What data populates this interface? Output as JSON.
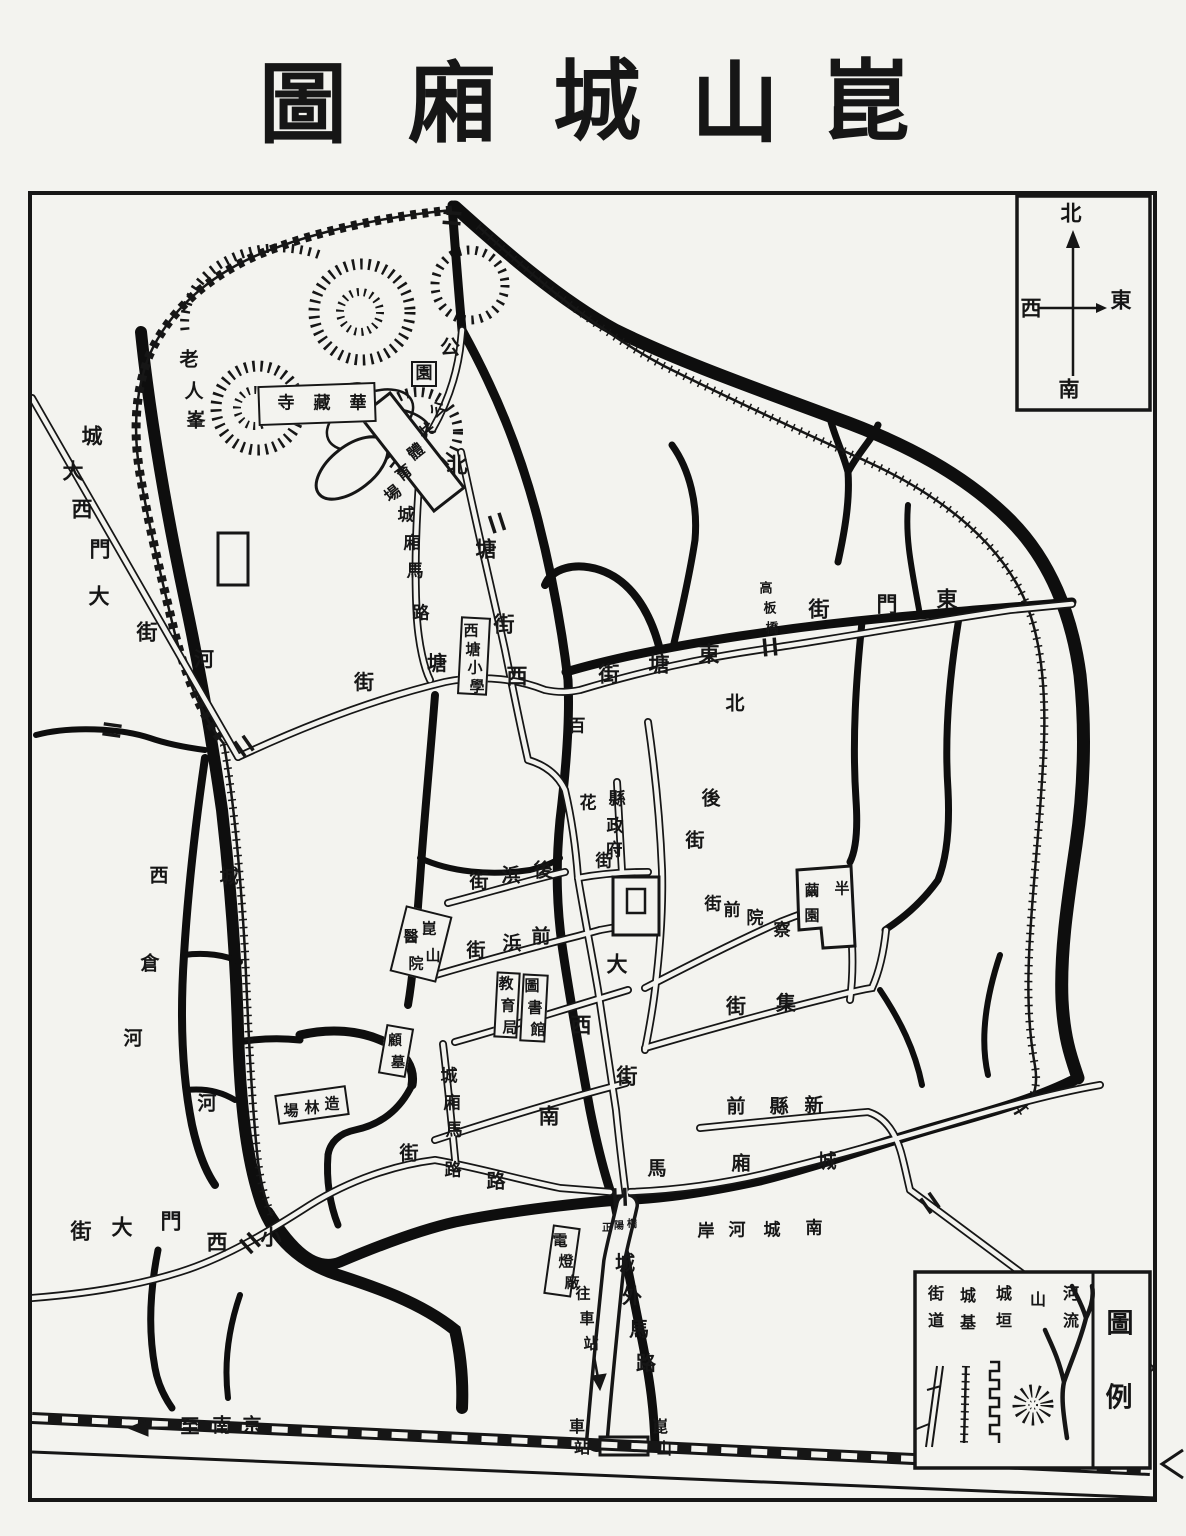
{
  "meta": {
    "title": "崑山城廂圖"
  },
  "colors": {
    "ink": "#161616",
    "paper": "#f3f3ef"
  },
  "compass": {
    "north": "北",
    "south": "南",
    "east": "東",
    "west": "西"
  },
  "legend": {
    "title": "圖例",
    "items": [
      {
        "label": "河流",
        "symbol": "river-branch"
      },
      {
        "label": "山",
        "symbol": "mountain-hachure"
      },
      {
        "label": "城垣",
        "symbol": "crenellated-wall"
      },
      {
        "label": "城基",
        "symbol": "wall-foundation"
      },
      {
        "label": "街道",
        "symbol": "double-line-street"
      }
    ]
  },
  "labels": [
    {
      "name": "map-title",
      "text": "崑山城廂圖",
      "size": 88,
      "chars": [
        [
          "圖",
          303,
          104
        ],
        [
          "廂",
          452,
          103
        ],
        [
          "城",
          597,
          101
        ],
        [
          "山",
          735,
          103
        ],
        [
          "崑",
          866,
          101
        ]
      ]
    },
    {
      "name": "compass-north",
      "text": "北",
      "size": 21,
      "chars": [
        [
          "北",
          1071,
          213
        ]
      ]
    },
    {
      "name": "compass-south",
      "text": "南",
      "size": 21,
      "chars": [
        [
          "南",
          1069,
          389
        ]
      ]
    },
    {
      "name": "compass-west",
      "text": "西",
      "size": 21,
      "chars": [
        [
          "西",
          1031,
          308
        ]
      ]
    },
    {
      "name": "compass-east",
      "text": "東",
      "size": 21,
      "chars": [
        [
          "東",
          1121,
          300
        ]
      ]
    },
    {
      "name": "legend-title",
      "text": "圖例",
      "size": 27,
      "chars": [
        [
          "圖",
          1120,
          1324
        ],
        [
          "例",
          1119,
          1398
        ]
      ]
    },
    {
      "name": "legend-item-river",
      "text": "河流",
      "size": 16,
      "chars": [
        [
          "河",
          1071,
          1294
        ],
        [
          "流",
          1071,
          1321
        ]
      ]
    },
    {
      "name": "legend-item-mountain",
      "text": "山",
      "size": 16,
      "chars": [
        [
          "山",
          1038,
          1300
        ]
      ]
    },
    {
      "name": "legend-item-wall",
      "text": "城垣",
      "size": 16,
      "chars": [
        [
          "城",
          1004,
          1294
        ],
        [
          "垣",
          1004,
          1321
        ]
      ]
    },
    {
      "name": "legend-item-base",
      "text": "城基",
      "size": 16,
      "chars": [
        [
          "城",
          968,
          1296
        ],
        [
          "基",
          968,
          1323
        ]
      ]
    },
    {
      "name": "legend-item-street",
      "text": "街道",
      "size": 16,
      "chars": [
        [
          "街",
          936,
          1294
        ],
        [
          "道",
          936,
          1321
        ]
      ]
    },
    {
      "name": "old-man-peak",
      "text": "老人峯",
      "size": 19,
      "chars": [
        [
          "老",
          189,
          360
        ],
        [
          "人",
          194,
          392
        ],
        [
          "峯",
          196,
          421
        ]
      ]
    },
    {
      "name": "huazang-temple",
      "text": "華藏寺",
      "size": 17,
      "box": [
        258,
        384,
        118,
        40,
        -2
      ],
      "chars": [
        [
          "寺",
          286,
          404
        ],
        [
          "藏",
          322,
          404
        ],
        [
          "華",
          358,
          404
        ]
      ]
    },
    {
      "name": "park-gong",
      "text": "公",
      "size": 20,
      "chars": [
        [
          "公",
          450,
          347
        ]
      ]
    },
    {
      "name": "park-yuan",
      "text": "園",
      "size": 17,
      "box": [
        411,
        361,
        26,
        26,
        0
      ],
      "chars": [
        [
          "園",
          424,
          374
        ]
      ]
    },
    {
      "name": "public-sports-ground",
      "text": "公共體育場",
      "size": 16,
      "rot": -38,
      "chars": [
        [
          "公",
          438,
          410
        ],
        [
          "共",
          427,
          431
        ],
        [
          "體",
          416,
          452
        ],
        [
          "育",
          404,
          473
        ],
        [
          "場",
          393,
          494
        ]
      ]
    },
    {
      "name": "north-tang-street",
      "text": "北塘街",
      "size": 21,
      "chars": [
        [
          "北",
          457,
          465
        ],
        [
          "塘",
          486,
          549
        ],
        [
          "街",
          504,
          624
        ]
      ]
    },
    {
      "name": "west-tang-char",
      "text": "西",
      "size": 21,
      "chars": [
        [
          "西",
          517,
          676
        ]
      ]
    },
    {
      "name": "ring-road-northwest",
      "text": "城廂馬路",
      "size": 17,
      "chars": [
        [
          "城",
          406,
          516
        ],
        [
          "廂",
          412,
          544
        ],
        [
          "馬",
          415,
          572
        ],
        [
          "路",
          421,
          614
        ]
      ]
    },
    {
      "name": "tang-street",
      "text": "塘街",
      "size": 20,
      "chars": [
        [
          "塘",
          437,
          663
        ],
        [
          "街",
          364,
          682
        ]
      ]
    },
    {
      "name": "xitang-primary-school",
      "text": "西塘小學",
      "size": 15,
      "box": [
        459,
        617,
        30,
        78,
        3
      ],
      "chars": [
        [
          "西",
          471,
          631
        ],
        [
          "塘",
          473,
          650
        ],
        [
          "小",
          475,
          668
        ],
        [
          "學",
          477,
          687
        ]
      ]
    },
    {
      "name": "wall-label-northwest",
      "text": "城",
      "size": 21,
      "chars": [
        [
          "城",
          92,
          436
        ]
      ]
    },
    {
      "name": "great-west-gate-street",
      "text": "大西門大街",
      "size": 21,
      "chars": [
        [
          "大",
          73,
          471
        ],
        [
          "西",
          82,
          509
        ],
        [
          "門",
          100,
          549
        ],
        [
          "大",
          99,
          596
        ],
        [
          "街",
          147,
          632
        ]
      ]
    },
    {
      "name": "moat-river-label-nw",
      "text": "河",
      "size": 20,
      "chars": [
        [
          "河",
          204,
          659
        ]
      ]
    },
    {
      "name": "east-tang-street",
      "text": "東塘街",
      "size": 21,
      "chars": [
        [
          "東",
          709,
          654
        ],
        [
          "塘",
          659,
          664
        ],
        [
          "街",
          609,
          674
        ]
      ]
    },
    {
      "name": "gaoban-bridge",
      "text": "高板橋",
      "size": 13,
      "chars": [
        [
          "高",
          766,
          589
        ],
        [
          "板",
          770,
          609
        ],
        [
          "橋",
          772,
          629
        ]
      ]
    },
    {
      "name": "east-gate-street",
      "text": "東門街",
      "size": 21,
      "chars": [
        [
          "東",
          947,
          599
        ],
        [
          "門",
          887,
          604
        ],
        [
          "街",
          819,
          609
        ]
      ]
    },
    {
      "name": "north-back-street",
      "text": "北後街",
      "size": 19,
      "chars": [
        [
          "北",
          735,
          704
        ],
        [
          "後",
          711,
          799
        ],
        [
          "街",
          695,
          841
        ]
      ]
    },
    {
      "name": "baihua-street",
      "text": "百花街",
      "size": 17,
      "chars": [
        [
          "百",
          577,
          727
        ],
        [
          "花",
          588,
          804
        ],
        [
          "街",
          604,
          862
        ]
      ]
    },
    {
      "name": "county-government",
      "text": "縣政府",
      "size": 17,
      "chars": [
        [
          "縣",
          617,
          800
        ],
        [
          "政",
          615,
          827
        ],
        [
          "府",
          614,
          851
        ]
      ]
    },
    {
      "name": "houbang-street",
      "text": "後浜街",
      "size": 19,
      "chars": [
        [
          "後",
          543,
          871
        ],
        [
          "浜",
          511,
          876
        ],
        [
          "街",
          479,
          882
        ]
      ]
    },
    {
      "name": "qianbang-street",
      "text": "前浜街",
      "size": 19,
      "chars": [
        [
          "前",
          541,
          937
        ],
        [
          "浜",
          512,
          944
        ],
        [
          "街",
          476,
          951
        ]
      ]
    },
    {
      "name": "kunshan-hospital",
      "text": "崑山醫院",
      "size": 15,
      "box": [
        397,
        910,
        48,
        68,
        14
      ],
      "chars": [
        [
          "崑",
          429,
          929
        ],
        [
          "山",
          433,
          956
        ],
        [
          "醫",
          411,
          937
        ],
        [
          "院",
          416,
          964
        ]
      ]
    },
    {
      "name": "education-bureau",
      "text": "教育局",
      "size": 15,
      "box": [
        495,
        972,
        24,
        66,
        3
      ],
      "chars": [
        [
          "教",
          506,
          984
        ],
        [
          "育",
          508,
          1006
        ],
        [
          "局",
          510,
          1028
        ]
      ]
    },
    {
      "name": "library",
      "text": "圖書館",
      "size": 15,
      "box": [
        521,
        974,
        26,
        68,
        3
      ],
      "chars": [
        [
          "圖",
          532,
          986
        ],
        [
          "書",
          535,
          1008
        ],
        [
          "館",
          538,
          1030
        ]
      ]
    },
    {
      "name": "great-west-street",
      "text": "大西街",
      "size": 21,
      "chars": [
        [
          "大",
          617,
          964
        ],
        [
          "西",
          581,
          1025
        ],
        [
          "街",
          627,
          1076
        ]
      ]
    },
    {
      "name": "south-street-char",
      "text": "南",
      "size": 21,
      "chars": [
        [
          "南",
          549,
          1116
        ]
      ]
    },
    {
      "name": "chayuan-front-street",
      "text": "察院前街",
      "size": 17,
      "chars": [
        [
          "察",
          782,
          931
        ],
        [
          "院",
          755,
          919
        ],
        [
          "前",
          732,
          911
        ],
        [
          "街",
          713,
          905
        ]
      ]
    },
    {
      "name": "banjian-garden",
      "text": "半繭園",
      "size": 15,
      "chars": [
        [
          "半",
          842,
          889
        ],
        [
          "繭",
          812,
          891
        ],
        [
          "園",
          812,
          916
        ]
      ]
    },
    {
      "name": "ji-street",
      "text": "集街",
      "size": 20,
      "chars": [
        [
          "集",
          786,
          1003
        ],
        [
          "街",
          736,
          1006
        ]
      ]
    },
    {
      "name": "new-county-front",
      "text": "新縣前",
      "size": 19,
      "chars": [
        [
          "新",
          814,
          1106
        ],
        [
          "縣",
          779,
          1107
        ],
        [
          "前",
          736,
          1107
        ]
      ]
    },
    {
      "name": "ring-road-south",
      "text": "城廂馬路",
      "size": 19,
      "chars": [
        [
          "城",
          827,
          1162
        ],
        [
          "廂",
          741,
          1164
        ],
        [
          "馬",
          657,
          1169
        ],
        [
          "路",
          496,
          1182
        ]
      ]
    },
    {
      "name": "ring-road-west",
      "text": "城廂馬路",
      "size": 17,
      "chars": [
        [
          "城",
          449,
          1077
        ],
        [
          "廂",
          452,
          1104
        ],
        [
          "馬",
          454,
          1131
        ],
        [
          "路",
          453,
          1171
        ]
      ]
    },
    {
      "name": "street-char-sw",
      "text": "街",
      "size": 19,
      "chars": [
        [
          "街",
          409,
          1154
        ]
      ]
    },
    {
      "name": "gu-tomb",
      "text": "顧墓",
      "size": 14,
      "box": [
        382,
        1026,
        28,
        50,
        10
      ],
      "chars": [
        [
          "顧",
          395,
          1041
        ],
        [
          "墓",
          398,
          1063
        ]
      ]
    },
    {
      "name": "forestry-ground",
      "text": "造林場",
      "size": 15,
      "box": [
        276,
        1090,
        72,
        30,
        -8
      ],
      "chars": [
        [
          "造",
          332,
          1104
        ],
        [
          "林",
          312,
          1108
        ],
        [
          "場",
          291,
          1111
        ]
      ]
    },
    {
      "name": "west-granary-river",
      "text": "西倉河",
      "size": 19,
      "chars": [
        [
          "西",
          159,
          876
        ],
        [
          "倉",
          150,
          964
        ],
        [
          "河",
          133,
          1039
        ]
      ]
    },
    {
      "name": "moat-cheng-west",
      "text": "城",
      "size": 19,
      "chars": [
        [
          "城",
          229,
          877
        ]
      ]
    },
    {
      "name": "moat-he-southwest",
      "text": "河",
      "size": 19,
      "chars": [
        [
          "河",
          207,
          1104
        ]
      ]
    },
    {
      "name": "small-west-gate-street",
      "text": "小西門大街",
      "size": 21,
      "chars": [
        [
          "小",
          271,
          1237
        ],
        [
          "西",
          217,
          1242
        ],
        [
          "門",
          171,
          1221
        ],
        [
          "大",
          122,
          1227
        ],
        [
          "街",
          81,
          1231
        ]
      ]
    },
    {
      "name": "south-moat-bank",
      "text": "南城河岸",
      "size": 17,
      "chars": [
        [
          "南",
          814,
          1229
        ],
        [
          "城",
          772,
          1231
        ],
        [
          "河",
          737,
          1231
        ],
        [
          "岸",
          706,
          1232
        ]
      ]
    },
    {
      "name": "zhengyang-bridge",
      "text": "正陽橋",
      "size": 10,
      "chars": [
        [
          "正",
          607,
          1229
        ],
        [
          "陽",
          619,
          1227
        ],
        [
          "橋",
          632,
          1225
        ]
      ]
    },
    {
      "name": "electric-light-plant",
      "text": "電燈廠",
      "size": 15,
      "box": [
        548,
        1226,
        28,
        70,
        8
      ],
      "chars": [
        [
          "電",
          560,
          1241
        ],
        [
          "燈",
          566,
          1262
        ],
        [
          "廠",
          572,
          1283
        ]
      ]
    },
    {
      "name": "to-station-label",
      "text": "往車站",
      "size": 15,
      "chars": [
        [
          "往",
          583,
          1294
        ],
        [
          "車",
          587,
          1319
        ],
        [
          "站",
          591,
          1344
        ]
      ]
    },
    {
      "name": "outside-city-road",
      "text": "城外馬路",
      "size": 20,
      "chars": [
        [
          "城",
          625,
          1263
        ],
        [
          "外",
          632,
          1296
        ],
        [
          "馬",
          639,
          1329
        ],
        [
          "路",
          646,
          1363
        ]
      ]
    },
    {
      "name": "station-label",
      "text": "車站",
      "size": 16,
      "chars": [
        [
          "車",
          577,
          1427
        ],
        [
          "站",
          582,
          1448
        ]
      ]
    },
    {
      "name": "kunshan-station-label",
      "text": "崑山",
      "size": 16,
      "chars": [
        [
          "崑",
          660,
          1427
        ],
        [
          "山",
          664,
          1449
        ]
      ]
    },
    {
      "name": "to-nanjing",
      "text": "至南京",
      "size": 19,
      "chars": [
        [
          "至",
          190,
          1427
        ],
        [
          "南",
          222,
          1426
        ],
        [
          "京",
          252,
          1426
        ]
      ]
    }
  ]
}
